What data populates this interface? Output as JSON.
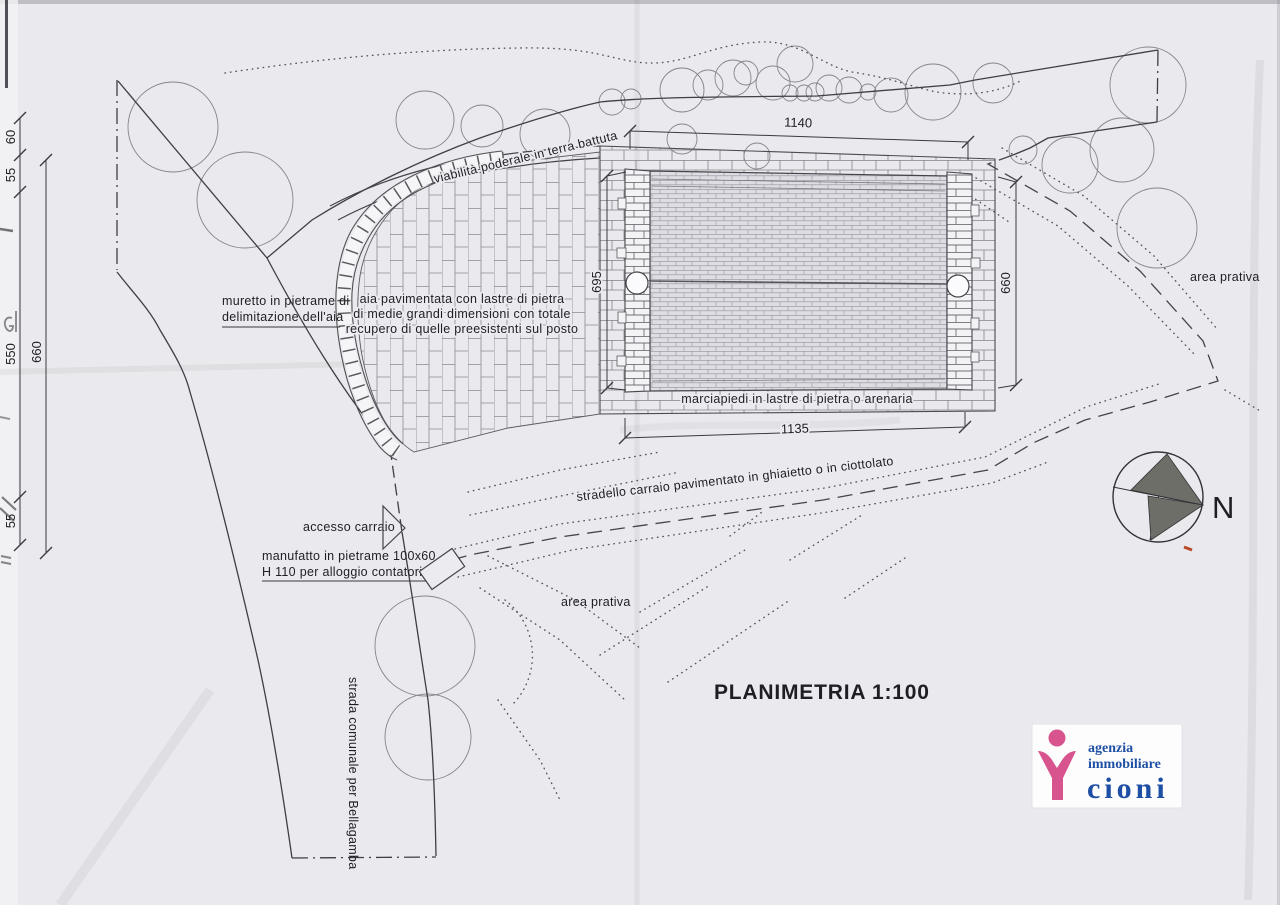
{
  "document": {
    "type": "scanned site plan",
    "title": "PLANIMETRIA",
    "scale": "1:100"
  },
  "labels": {
    "viabilita": "viabilità poderale in terra battuta",
    "aia_line1": "aia pavimentata con lastre di pietra",
    "aia_line2": "di medie grandi dimensioni con totale",
    "aia_line3": "recupero di quelle preesistenti sul posto",
    "muretto_line1": "muretto in pietrame di",
    "muretto_line2": "delimitazione dell'aia",
    "marciapiedi": "marciapiedi in lastre di pietra o arenaria",
    "stradello": "stradello carraio pavimentato in ghiaietto o in ciottolato",
    "accesso": "accesso carraio",
    "manufatto_line1": "manufatto in pietrame 100x60",
    "manufatto_line2": "H 110 per alloggio contatori",
    "area_prativa_east": "area prativa",
    "area_prativa_south": "area prativa",
    "strada_comunale": "strada comunale per Bellagamba"
  },
  "dimensions": {
    "top_width": "1140",
    "bottom_width": "1135",
    "left_height": "695",
    "right_height": "660",
    "west_seg_60": "60",
    "west_seg_55a": "55",
    "west_seg_550": "550",
    "west_seg_55b": "55",
    "west_total_660": "660"
  },
  "north_arrow": {
    "label": "N"
  },
  "logo": {
    "line1": "agenzia",
    "line2": "immobiliare",
    "line3": "cioni"
  },
  "colors": {
    "paper": "#eae9ed",
    "ink": "#3a3a40",
    "logo_pink": "#d8548e",
    "logo_blue": "#1d4fa5",
    "north_fill": "#6e6e69",
    "red_mark": "#b94a28"
  }
}
